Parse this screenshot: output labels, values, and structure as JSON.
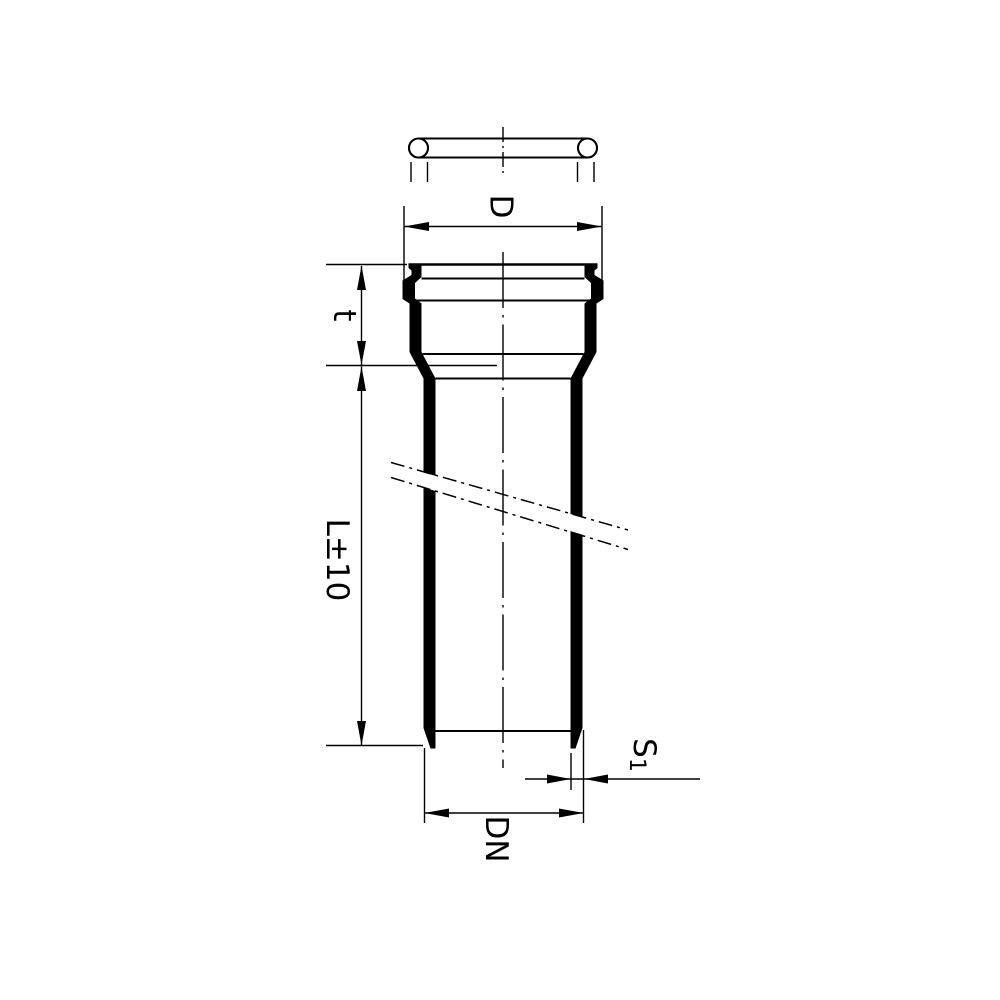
{
  "drawing": {
    "dimension_labels": {
      "outer_diameter": "D",
      "socket_depth": "t",
      "length_tolerance": "L±10",
      "wall_thickness_symbol": "S",
      "wall_thickness_subscript": "1",
      "nominal_diameter": "DN"
    },
    "colors": {
      "line": "#000000",
      "background": "#ffffff"
    }
  }
}
